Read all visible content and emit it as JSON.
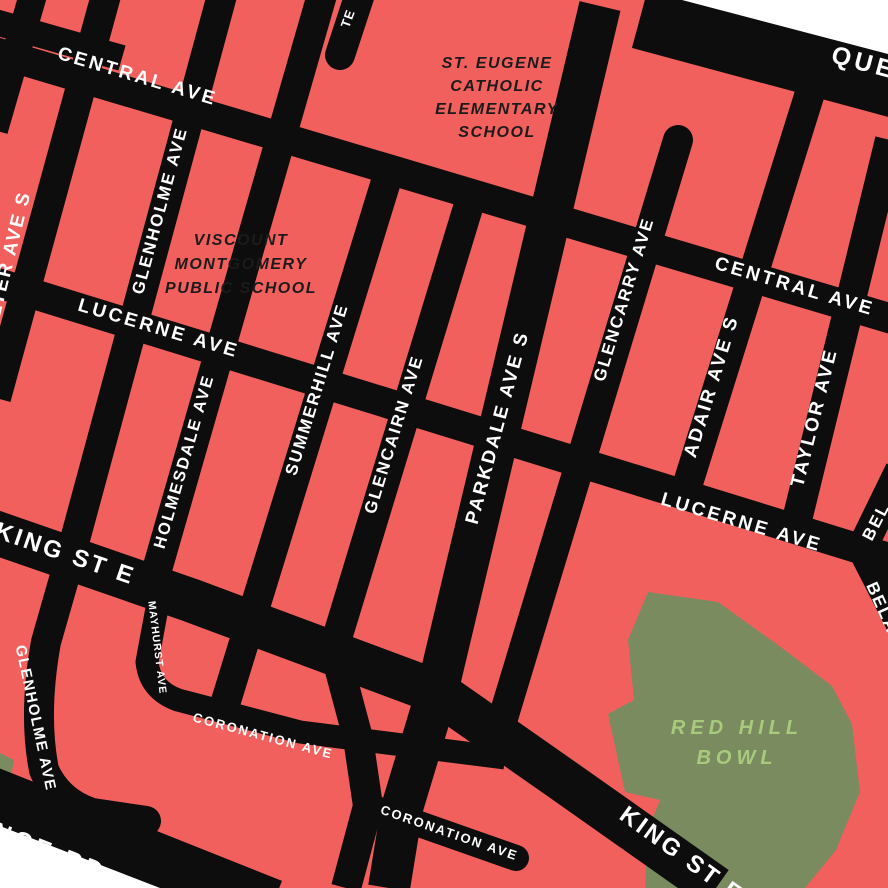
{
  "colors": {
    "background": "#F2605E",
    "road": "#0D0D0D",
    "park": "#7A8C5F",
    "park-text": "#A9CA7D",
    "school-text": "#1B1B1B",
    "street-text": "#FFFFFF",
    "outside": "#FFFFFF"
  },
  "streets": {
    "central_1": "CENTRAL AVE",
    "central_2": "CENTRAL AVE",
    "lucerne_1": "LUCERNE AVE",
    "lucerne_2": "LUCERNE AVE",
    "queenston": "QUEENSTON RD",
    "king_1": "KING ST E",
    "king_2": "KING ST E",
    "lawrence": "LAWRENCE RD",
    "coronation_1": "CORONATION AVE",
    "coronation_2": "CORONATION AVE",
    "mayhurst": "MAYHURST AVE",
    "walter": "WALTER AVE S",
    "glenholme_n": "GLENHOLME AVE",
    "glenholme_s": "GLENHOLME AVE",
    "holmesdale": "HOLMESDALE AVE",
    "summerhill": "SUMMERHILL AVE",
    "glencairn": "GLENCAIRN AVE",
    "parkdale": "PARKDALE AVE S",
    "glencarry": "GLENCARRY AVE",
    "adair": "ADAIR AVE S",
    "taylor": "TAYLOR AVE",
    "te_stub_fragment": "TE",
    "bel_upper_fragment": "BEL",
    "bel_lower_fragment": "BELA"
  },
  "places": {
    "st_eugene": {
      "line1": "ST. EUGENE",
      "line2": "CATHOLIC",
      "line3": "ELEMENTARY",
      "line4": "SCHOOL"
    },
    "viscount": {
      "line1": "VISCOUNT",
      "line2": "MONTGOMERY",
      "line3": "PUBLIC SCHOOL"
    },
    "red_hill_bowl": {
      "line1": "RED HILL",
      "line2": "BOWL"
    }
  }
}
